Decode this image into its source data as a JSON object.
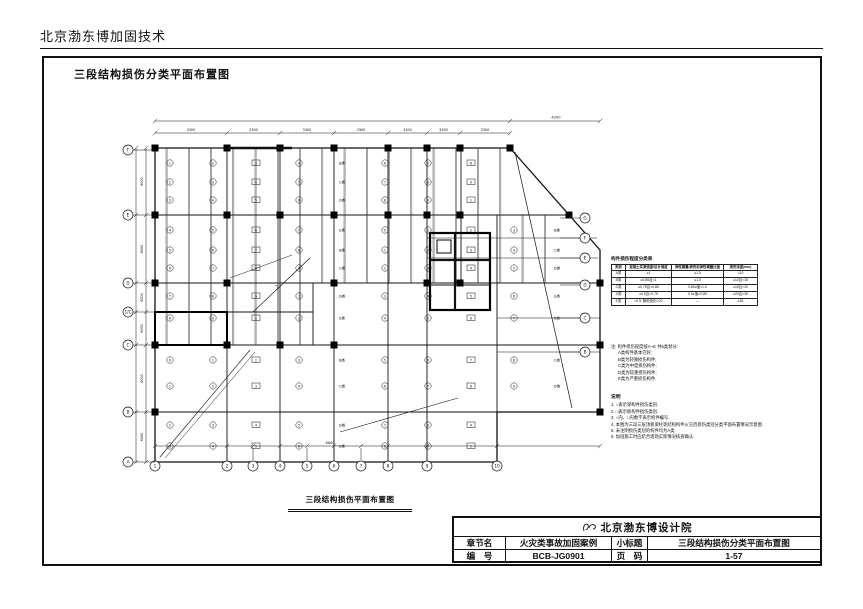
{
  "page": {
    "header": "北京渤东博加固技术",
    "drawing_title": "三段结构损伤分类平面布置图",
    "plan_caption": "三段结构损伤平面布置图"
  },
  "damage_table": {
    "title": "构件损伤程度分类表",
    "headers": [
      "类别",
      "混凝土实测强度/设计强度",
      "弹性模量/损伤前弹性模量比值",
      "损伤深度(mm)"
    ],
    "rows": [
      [
        "A类",
        "≥1",
        "≥1.0",
        "<10"
      ],
      [
        "B类",
        "≥0.85且<1",
        "≥1.0",
        "≥10且<15"
      ],
      [
        "C类",
        "≥0.75且<0.85",
        "0.80≤值<1.0",
        "≥15且<20"
      ],
      [
        "D类",
        "≥0.5且<0.75",
        "0.5≤值<0.85",
        "≥20且<35"
      ],
      [
        "E类",
        "<0.5, 酥松炭化C20",
        "—",
        "≥35"
      ]
    ]
  },
  "notes": {
    "intro": "注: 构件损伤程度按A~E 共5类划分:",
    "items": [
      "A类构件基本完好;",
      "B类为轻微损伤构件;",
      "C类为中度损伤构件;",
      "D类为较重损伤构件;",
      "E类为严重损伤构件."
    ]
  },
  "legend": {
    "title": "说明",
    "items": [
      "1. ○表示梁构件损伤类别.",
      "2. □表示板构件损伤类别.",
      "3. ○内、□内数字表示构件编号.",
      "4. 本图为三段三层顶板梁柱等结构构件火灾后损伤类别分类平面布置情况示意图.",
      "5. 未注明损伤类别的构件均为A类.",
      "6. 加固施工时应结合现场实际情况核查确认."
    ]
  },
  "title_block": {
    "company": "北京渤东博设计院",
    "row1_label1": "章节名",
    "row1_value1": "火灾类事故加固案例",
    "row1_label2": "小标题",
    "row1_value2": "三段结构损伤分类平面布置图",
    "row2_label1": "编　号",
    "row2_value1": "BCB-JG0901",
    "row2_label2": "页　码",
    "row2_value2": "1-57"
  },
  "plan": {
    "bay_dim": "3300",
    "right_dim": "4200",
    "left_dim": "6000",
    "bottom_dim": "6600",
    "bottom_axes": [
      "1",
      "2",
      "3",
      "4",
      "5",
      "6",
      "7",
      "8",
      "9",
      "10"
    ],
    "left_axes": [
      "F",
      "E",
      "D",
      "1/C",
      "C",
      "B",
      "A"
    ],
    "right_axes": [
      "G",
      "F",
      "E",
      "D",
      "C",
      "B"
    ],
    "class_labels": [
      "B类",
      "C类",
      "D类",
      "E类"
    ]
  }
}
